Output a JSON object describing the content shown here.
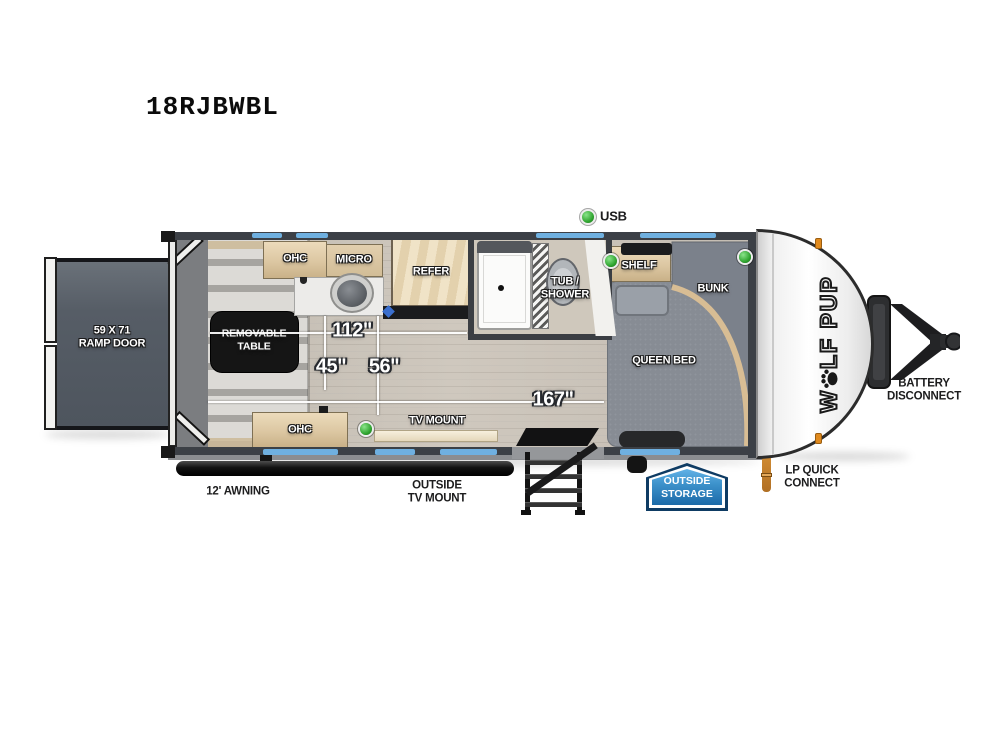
{
  "page": {
    "title": "18RJBWBL"
  },
  "legend": {
    "usb_label": "USB"
  },
  "colors": {
    "wall_gray": "#3c4046",
    "window_blue": "#6fb0e0",
    "usb_green": "#2fa42f",
    "storage_badge_blue": "#2f7fba",
    "wood_tan": "#e0cdab",
    "marker_orange": "#e08a1e"
  },
  "floorplan": {
    "ramp_door": {
      "line1": "59 X 71",
      "line2": "RAMP DOOR"
    },
    "removable_table": {
      "line1": "REMOVABLE",
      "line2": "TABLE"
    },
    "ohc_top": "OHC",
    "ohc_bottom": "OHC",
    "micro": "MICRO",
    "refer": "REFER",
    "tub_shower": {
      "line1": "TUB /",
      "line2": "SHOWER"
    },
    "shelf": "SHELF",
    "bunk": "BUNK",
    "queen_bed": "QUEEN BED",
    "tv_mount": "TV MOUNT",
    "dim_112": "112\"",
    "dim_45": "45\"",
    "dim_56": "56\"",
    "dim_167": "167\""
  },
  "exterior": {
    "awning": "12' AWNING",
    "outside_tv_mount": {
      "line1": "OUTSIDE",
      "line2": "TV MOUNT"
    },
    "outside_storage": {
      "line1": "OUTSIDE",
      "line2": "STORAGE"
    },
    "lp_quick_connect": {
      "line1": "LP QUICK",
      "line2": "CONNECT"
    },
    "battery_disconnect": {
      "line1": "BATTERY",
      "line2": "DISCONNECT"
    },
    "brand_logo": {
      "prefix": "W",
      "suffix": "LF PUP",
      "full_name": "WOLF PUP"
    }
  }
}
